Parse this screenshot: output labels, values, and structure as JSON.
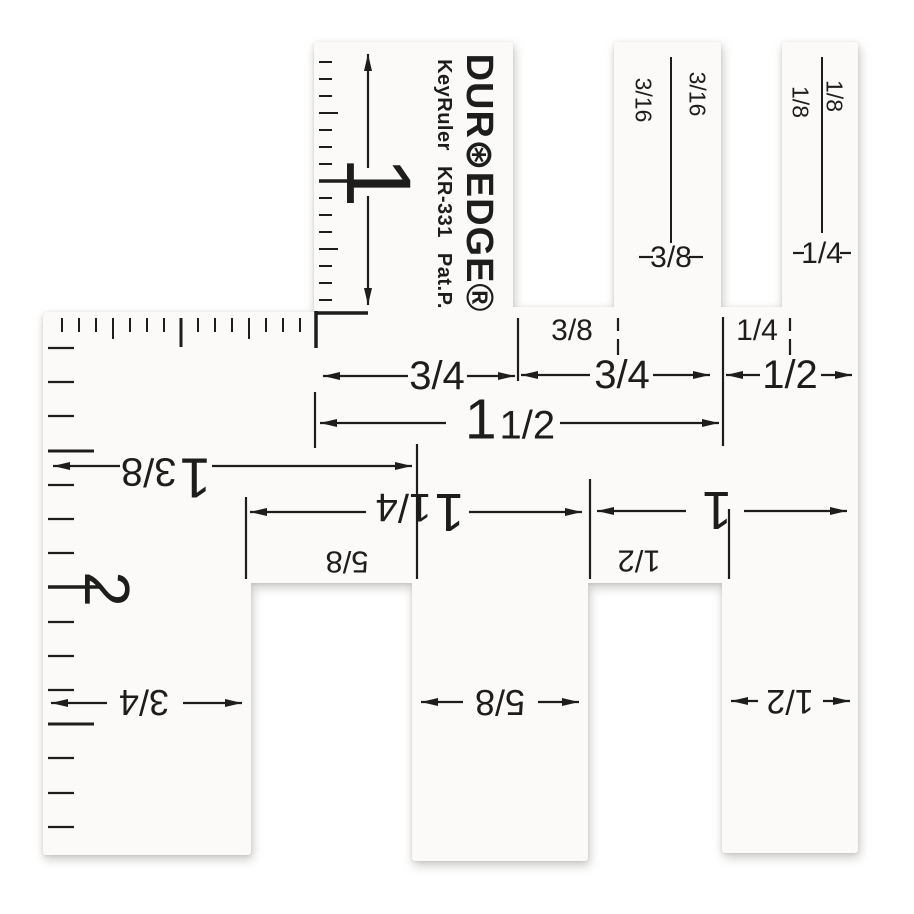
{
  "product": {
    "brand": "DUR⊛EDGE®",
    "model": "KeyRuler KR-331 Pat.P."
  },
  "vertical_scales": {
    "tab_inch_mark": "1",
    "body_inch_mark": "2"
  },
  "key_slots": {
    "slot_a": {
      "left_label": "3/16",
      "right_label": "3/16",
      "width_label": "3/8"
    },
    "slot_b": {
      "left_label": "1/8",
      "right_label": "1/8",
      "width_label": "1/4"
    }
  },
  "dims": {
    "top": {
      "seg1": "3/4",
      "notch1": "3/8",
      "seg2": "3/4",
      "notch2": "1/4",
      "seg3": "1/2",
      "overall_whole": "1",
      "overall_frac": "1/2"
    },
    "mid": {
      "d138_whole": "1",
      "d138_frac": "3/8",
      "d114_whole": "1",
      "d114_frac": "1/4",
      "d1": "1",
      "w58": "5/8",
      "w12": "1/2"
    },
    "bottom": {
      "left": "3/4",
      "middle": "5/8",
      "right": "1/2"
    }
  },
  "colors": {
    "ink": "#1d1d1d",
    "plastic": "#fbfaf8",
    "background": "#ffffff"
  }
}
